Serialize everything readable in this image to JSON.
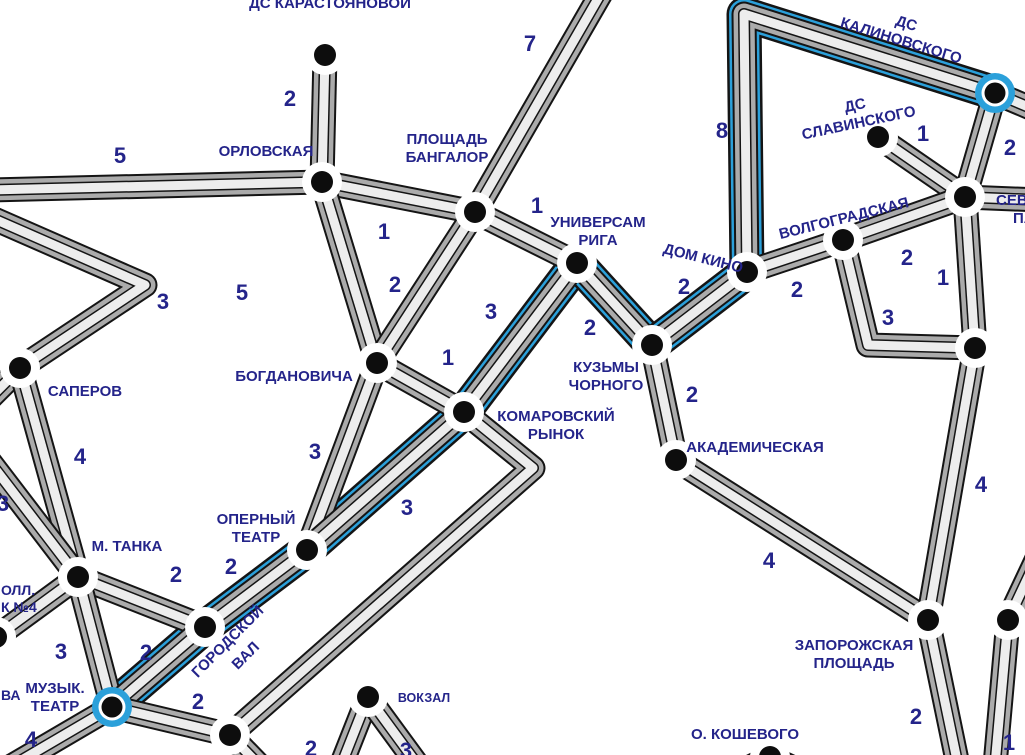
{
  "map": {
    "title": "transit-route-map",
    "background": "#ffffff",
    "colors": {
      "label": "#24248a",
      "route_blue": "#2ba0da",
      "road_casing": "#141414",
      "road_dark": "#ababab",
      "road_light": "#ededed",
      "node_fill": "#0d0d0d",
      "node_ring": "#ffffff"
    },
    "roads": [
      {
        "pts": [
          [
            325,
            55
          ],
          [
            322,
            182
          ]
        ]
      },
      {
        "pts": [
          [
            -10,
            190
          ],
          [
            322,
            182
          ]
        ]
      },
      {
        "pts": [
          [
            322,
            182
          ],
          [
            475,
            212
          ]
        ]
      },
      {
        "pts": [
          [
            322,
            182
          ],
          [
            377,
            363
          ]
        ]
      },
      {
        "pts": [
          [
            603,
            -10
          ],
          [
            475,
            212
          ]
        ]
      },
      {
        "pts": [
          [
            475,
            212
          ],
          [
            577,
            263
          ]
        ]
      },
      {
        "pts": [
          [
            475,
            212
          ],
          [
            377,
            363
          ]
        ]
      },
      {
        "pts": [
          [
            377,
            363
          ],
          [
            307,
            550
          ]
        ]
      },
      {
        "pts": [
          [
            377,
            363
          ],
          [
            464,
            412
          ]
        ]
      },
      {
        "pts": [
          [
            577,
            263
          ],
          [
            464,
            412
          ]
        ],
        "blue": true
      },
      {
        "pts": [
          [
            577,
            263
          ],
          [
            652,
            345
          ]
        ],
        "blue": true
      },
      {
        "pts": [
          [
            652,
            345
          ],
          [
            747,
            272
          ]
        ],
        "blue": true
      },
      {
        "pts": [
          [
            747,
            272
          ],
          [
            744,
            14
          ],
          [
            995,
            93
          ]
        ],
        "blue": true
      },
      {
        "pts": [
          [
            652,
            345
          ],
          [
            676,
            460
          ]
        ]
      },
      {
        "pts": [
          [
            676,
            460
          ],
          [
            928,
            620
          ]
        ]
      },
      {
        "pts": [
          [
            878,
            137
          ],
          [
            965,
            197
          ]
        ]
      },
      {
        "pts": [
          [
            995,
            93
          ],
          [
            965,
            197
          ]
        ]
      },
      {
        "pts": [
          [
            995,
            93
          ],
          [
            1040,
            112
          ]
        ]
      },
      {
        "pts": [
          [
            965,
            197
          ],
          [
            1040,
            200
          ]
        ]
      },
      {
        "pts": [
          [
            747,
            272
          ],
          [
            843,
            240
          ]
        ]
      },
      {
        "pts": [
          [
            843,
            240
          ],
          [
            965,
            197
          ]
        ]
      },
      {
        "pts": [
          [
            965,
            197
          ],
          [
            975,
            348
          ]
        ]
      },
      {
        "pts": [
          [
            843,
            240
          ],
          [
            868,
            345
          ],
          [
            975,
            348
          ]
        ]
      },
      {
        "pts": [
          [
            975,
            348
          ],
          [
            928,
            620
          ]
        ]
      },
      {
        "pts": [
          [
            928,
            620
          ],
          [
            958,
            765
          ]
        ]
      },
      {
        "pts": [
          [
            1040,
            552
          ],
          [
            1008,
            620
          ],
          [
            995,
            765
          ]
        ]
      },
      {
        "pts": [
          [
            -8,
            218
          ],
          [
            145,
            285
          ],
          [
            20,
            368
          ]
        ]
      },
      {
        "pts": [
          [
            20,
            368
          ],
          [
            -12,
            400
          ]
        ]
      },
      {
        "pts": [
          [
            20,
            368
          ],
          [
            78,
            577
          ]
        ]
      },
      {
        "pts": [
          [
            -10,
            462
          ],
          [
            78,
            577
          ]
        ]
      },
      {
        "pts": [
          [
            78,
            577
          ],
          [
            205,
            627
          ]
        ]
      },
      {
        "pts": [
          [
            78,
            577
          ],
          [
            112,
            707
          ]
        ]
      },
      {
        "pts": [
          [
            78,
            577
          ],
          [
            -8,
            640
          ]
        ]
      },
      {
        "pts": [
          [
            112,
            707
          ],
          [
            205,
            627
          ]
        ],
        "blue": true
      },
      {
        "pts": [
          [
            205,
            627
          ],
          [
            307,
            550
          ]
        ],
        "blue": true
      },
      {
        "pts": [
          [
            307,
            550
          ],
          [
            464,
            412
          ]
        ],
        "blue": true
      },
      {
        "pts": [
          [
            112,
            707
          ],
          [
            230,
            735
          ]
        ]
      },
      {
        "pts": [
          [
            112,
            707
          ],
          [
            8,
            768
          ]
        ]
      },
      {
        "pts": [
          [
            230,
            735
          ],
          [
            533,
            468
          ],
          [
            464,
            412
          ]
        ]
      },
      {
        "pts": [
          [
            230,
            735
          ],
          [
            262,
            768
          ]
        ]
      },
      {
        "pts": [
          [
            368,
            697
          ],
          [
            340,
            768
          ]
        ]
      },
      {
        "pts": [
          [
            368,
            697
          ],
          [
            420,
            768
          ]
        ]
      },
      {
        "pts": [
          [
            700,
            792
          ],
          [
            770,
            757
          ],
          [
            845,
            792
          ]
        ]
      }
    ],
    "stations": [
      {
        "id": "ds-karastoyanovoy",
        "x": 325,
        "y": 55,
        "ring": "white"
      },
      {
        "id": "orlovskaya",
        "x": 322,
        "y": 182,
        "ring": "white"
      },
      {
        "id": "ploshchad-bangalor",
        "x": 475,
        "y": 212,
        "ring": "white"
      },
      {
        "id": "universam-riga",
        "x": 577,
        "y": 263,
        "ring": "white"
      },
      {
        "id": "dom-kino",
        "x": 747,
        "y": 272,
        "ring": "white"
      },
      {
        "id": "volgogradskaya",
        "x": 843,
        "y": 240,
        "ring": "white"
      },
      {
        "id": "ds-kalinovskogo",
        "x": 995,
        "y": 93,
        "ring": "blue"
      },
      {
        "id": "ds-slavinskogo",
        "x": 878,
        "y": 137,
        "ring": "white"
      },
      {
        "id": "sevastopolsky-park",
        "x": 965,
        "y": 197,
        "ring": "white"
      },
      {
        "id": "saperov",
        "x": 20,
        "y": 368,
        "ring": "white"
      },
      {
        "id": "bogdanovicha",
        "x": 377,
        "y": 363,
        "ring": "white"
      },
      {
        "id": "komarovsky-rynok",
        "x": 464,
        "y": 412,
        "ring": "white"
      },
      {
        "id": "kuzmy-chornogo",
        "x": 652,
        "y": 345,
        "ring": "white"
      },
      {
        "id": "akademicheskaya",
        "x": 676,
        "y": 460,
        "ring": "white"
      },
      {
        "id": "m-tanka",
        "x": 78,
        "y": 577,
        "ring": "white"
      },
      {
        "id": "operny-teatr",
        "x": 307,
        "y": 550,
        "ring": "white"
      },
      {
        "id": "gorodskoy-val",
        "x": 205,
        "y": 627,
        "ring": "white"
      },
      {
        "id": "muzyk-teatr",
        "x": 112,
        "y": 707,
        "ring": "blue"
      },
      {
        "id": "unnamed-southwest",
        "x": 230,
        "y": 735,
        "ring": "white"
      },
      {
        "id": "vokzal",
        "x": 368,
        "y": 697,
        "ring": "white"
      },
      {
        "id": "zaporozhskaya-ploshchad",
        "x": 928,
        "y": 620,
        "ring": "white"
      },
      {
        "id": "unnamed-east",
        "x": 1008,
        "y": 620,
        "ring": "white"
      },
      {
        "id": "unnamed-park-corner",
        "x": 975,
        "y": 348,
        "ring": "white"
      },
      {
        "id": "o-koshevogo",
        "x": 770,
        "y": 757,
        "ring": "white"
      },
      {
        "id": "unnamed-west-edge",
        "x": -4,
        "y": 637,
        "ring": "white"
      }
    ],
    "labels": [
      {
        "lines": [
          "ДС КАРАСТОЯНОВОЙ"
        ],
        "x": 330,
        "y": 8
      },
      {
        "lines": [
          "ОРЛОВСКАЯ"
        ],
        "x": 266,
        "y": 156
      },
      {
        "lines": [
          "ПЛОЩАДЬ",
          "БАНГАЛОР"
        ],
        "x": 447,
        "y": 144
      },
      {
        "lines": [
          "УНИВЕРСАМ",
          "РИГА"
        ],
        "x": 598,
        "y": 227
      },
      {
        "lines": [
          "ДОМ КИНО"
        ],
        "x": 702,
        "y": 263,
        "rotate": 14
      },
      {
        "lines": [
          "ВОЛГОГРАДСКАЯ"
        ],
        "x": 845,
        "y": 223,
        "rotate": -14
      },
      {
        "lines": [
          "ДС",
          "КАЛИНОВСКОГО"
        ],
        "x": 905,
        "y": 28,
        "rotate": 17
      },
      {
        "lines": [
          "ДС",
          "СЛАВИНСКОГО"
        ],
        "x": 856,
        "y": 110,
        "rotate": -12
      },
      {
        "lines": [
          "СЕВА"
        ],
        "x": 996,
        "y": 205,
        "anchor": "start"
      },
      {
        "lines": [
          "ПА"
        ],
        "x": 1013,
        "y": 223,
        "anchor": "start"
      },
      {
        "lines": [
          "САПЕРОВ"
        ],
        "x": 85,
        "y": 396
      },
      {
        "lines": [
          "БОГДАНОВИЧА"
        ],
        "x": 294,
        "y": 381
      },
      {
        "lines": [
          "КОМАРОВСКИЙ",
          "РЫНОК"
        ],
        "x": 556,
        "y": 421
      },
      {
        "lines": [
          "КУЗЬМЫ",
          "ЧОРНОГО"
        ],
        "x": 606,
        "y": 372
      },
      {
        "lines": [
          "АКАДЕМИЧЕСКАЯ"
        ],
        "x": 755,
        "y": 452
      },
      {
        "lines": [
          "М. ТАНКА"
        ],
        "x": 127,
        "y": 551
      },
      {
        "lines": [
          "ОПЕРНЫЙ",
          "ТЕАТР"
        ],
        "x": 256,
        "y": 524
      },
      {
        "lines": [
          "ГОРОДСКОЙ"
        ],
        "x": 231,
        "y": 645,
        "rotate": -45
      },
      {
        "lines": [
          "ВАЛ"
        ],
        "x": 249,
        "y": 659,
        "rotate": -45
      },
      {
        "lines": [
          "МУЗЫК.",
          "ТЕАТР"
        ],
        "x": 55,
        "y": 693
      },
      {
        "lines": [
          "ВОКЗАЛ"
        ],
        "x": 424,
        "y": 702,
        "size": 12.5
      },
      {
        "lines": [
          "ЗАПОРОЖСКАЯ",
          "ПЛОЩАДЬ"
        ],
        "x": 854,
        "y": 650
      },
      {
        "lines": [
          "О. КОШЕВОГО"
        ],
        "x": 745,
        "y": 739
      },
      {
        "lines": [
          "ОЛЛ."
        ],
        "x": 1,
        "y": 595,
        "anchor": "start",
        "size": 14
      },
      {
        "lines": [
          "К №4"
        ],
        "x": 1,
        "y": 612,
        "anchor": "start",
        "size": 14
      },
      {
        "lines": [
          "ВА"
        ],
        "x": 1,
        "y": 700,
        "anchor": "start",
        "size": 14
      }
    ],
    "edge_weights": [
      {
        "text": "5",
        "x": 120,
        "y": 155
      },
      {
        "text": "2",
        "x": 290,
        "y": 98
      },
      {
        "text": "7",
        "x": 530,
        "y": 43
      },
      {
        "text": "8",
        "x": 722,
        "y": 130
      },
      {
        "text": "1",
        "x": 923,
        "y": 133
      },
      {
        "text": "2",
        "x": 1010,
        "y": 147
      },
      {
        "text": "1",
        "x": 384,
        "y": 231
      },
      {
        "text": "1",
        "x": 537,
        "y": 205
      },
      {
        "text": "2",
        "x": 395,
        "y": 284
      },
      {
        "text": "5",
        "x": 242,
        "y": 292
      },
      {
        "text": "3",
        "x": 163,
        "y": 301
      },
      {
        "text": "2",
        "x": 907,
        "y": 257
      },
      {
        "text": "1",
        "x": 943,
        "y": 277
      },
      {
        "text": "3",
        "x": 888,
        "y": 317
      },
      {
        "text": "2",
        "x": 797,
        "y": 289
      },
      {
        "text": "2",
        "x": 684,
        "y": 286
      },
      {
        "text": "2",
        "x": 590,
        "y": 327
      },
      {
        "text": "3",
        "x": 491,
        "y": 311
      },
      {
        "text": "1",
        "x": 448,
        "y": 357
      },
      {
        "text": "2",
        "x": 692,
        "y": 394
      },
      {
        "text": "3",
        "x": 315,
        "y": 451
      },
      {
        "text": "3",
        "x": 407,
        "y": 507
      },
      {
        "text": "4",
        "x": 80,
        "y": 456
      },
      {
        "text": "3",
        "x": 3,
        "y": 503
      },
      {
        "text": "4",
        "x": 769,
        "y": 560
      },
      {
        "text": "4",
        "x": 981,
        "y": 484
      },
      {
        "text": "2",
        "x": 176,
        "y": 574
      },
      {
        "text": "2",
        "x": 231,
        "y": 566
      },
      {
        "text": "3",
        "x": 61,
        "y": 651
      },
      {
        "text": "2",
        "x": 146,
        "y": 652
      },
      {
        "text": "2",
        "x": 198,
        "y": 701
      },
      {
        "text": "4",
        "x": 31,
        "y": 739
      },
      {
        "text": "2",
        "x": 311,
        "y": 748
      },
      {
        "text": "3",
        "x": 406,
        "y": 750
      },
      {
        "text": "2",
        "x": 916,
        "y": 716
      },
      {
        "text": "1",
        "x": 1009,
        "y": 742
      }
    ]
  }
}
